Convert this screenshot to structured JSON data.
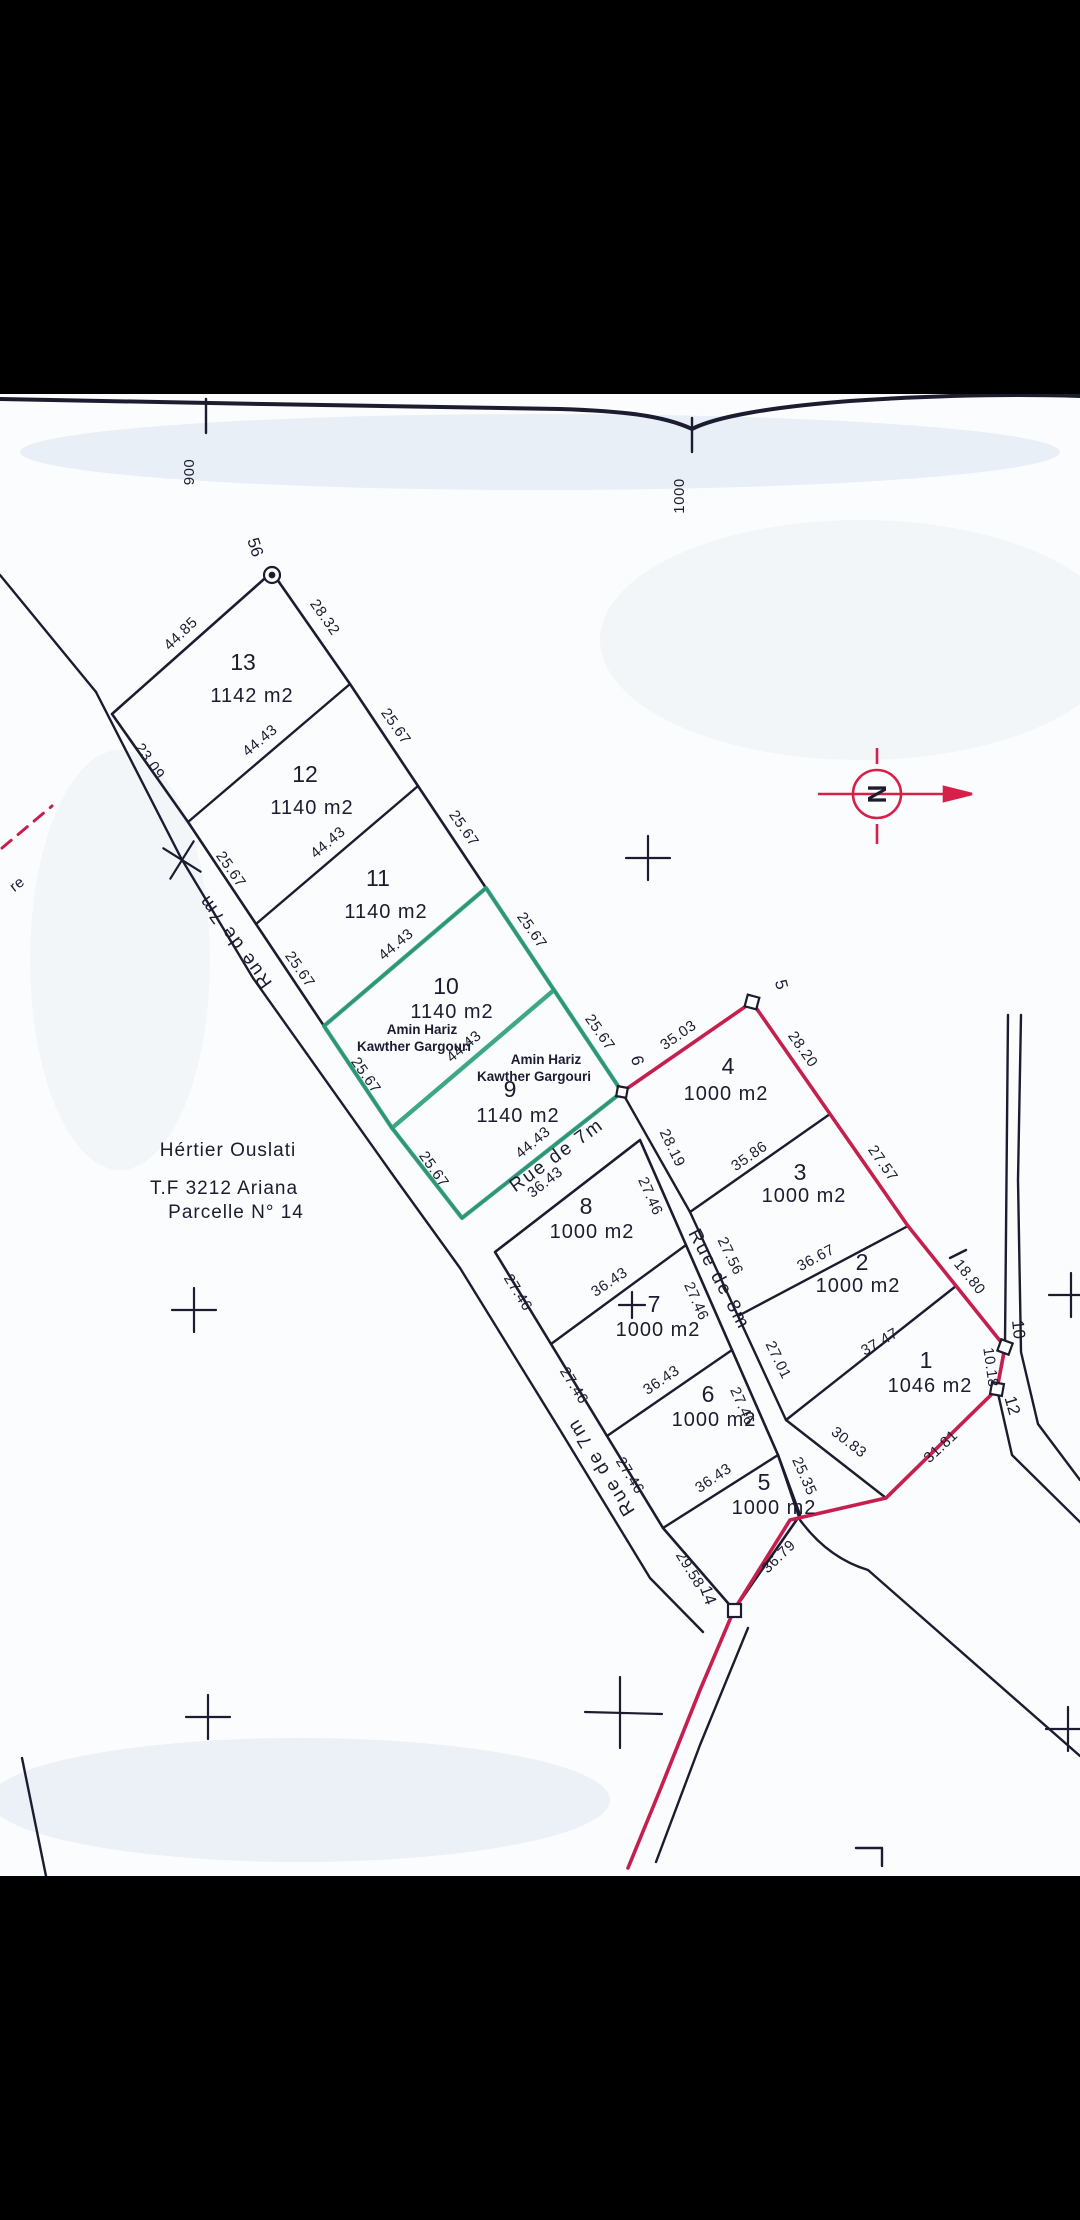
{
  "document_type": "cadastral-subdivision-plan",
  "title_block": {
    "l1": "Hértier Ouslati",
    "l2": "T.F 3212 Ariana",
    "l3": "Parcelle N° 14"
  },
  "ruler": {
    "r900": "900",
    "r1000": "1000"
  },
  "north": {
    "label": "N"
  },
  "edge_fragment": "re",
  "roads": {
    "rue7a": "Rue de 7m",
    "rue7b": "Rue de 7m",
    "rue7c": "Rue de 7m",
    "rue8": "Rue de 8m"
  },
  "vertices": {
    "v56": "56",
    "v5": "5",
    "v6": "6",
    "v12": "12",
    "v14": "14",
    "road10": "10"
  },
  "owners": {
    "o10": {
      "l1": "Amin Hariz",
      "l2": "Kawther Gargouri"
    },
    "o9": {
      "l1": "Amin Hariz",
      "l2": "Kawther Gargouri"
    }
  },
  "parcels": {
    "p13": {
      "num": "13",
      "area": "1142 m2"
    },
    "p12": {
      "num": "12",
      "area": "1140 m2"
    },
    "p11": {
      "num": "11",
      "area": "1140 m2"
    },
    "p10": {
      "num": "10",
      "area": "1140 m2"
    },
    "p9": {
      "num": "9",
      "area": "1140 m2"
    },
    "p8": {
      "num": "8",
      "area": "1000 m2"
    },
    "p7": {
      "num": "7",
      "area": "1000 m2"
    },
    "p6": {
      "num": "6",
      "area": "1000 m2"
    },
    "p5": {
      "num": "5",
      "area": "1000 m2"
    },
    "p4": {
      "num": "4",
      "area": "1000 m2"
    },
    "p3": {
      "num": "3",
      "area": "1000 m2"
    },
    "p2": {
      "num": "2",
      "area": "1000 m2"
    },
    "p1": {
      "num": "1",
      "area": "1046 m2"
    }
  },
  "dims": {
    "p13_nw": "44.85",
    "p13_ne": "28.32",
    "p13_se": "44.43",
    "p12_ne": "25.67",
    "p12_sw": "25.67",
    "p12_se": "44.43",
    "p11_ne": "25.67",
    "p11_sw": "25.67",
    "p11_se": "44.43",
    "p10_ne": "25.67",
    "p10_sw": "25.67",
    "p10_se": "44.43",
    "p9_ne": "25.67",
    "p9_sw": "25.67",
    "p9_se": "44.43",
    "road23": "23.09",
    "p4_nw": "35.03",
    "p4_ne": "28.20",
    "p4_sw": "28.19",
    "p4_se": "35.86",
    "p3_ne": "27.57",
    "p3_sw": "27.56",
    "p3_se": "36.67",
    "p2_sw": "27.01",
    "p2_se": "37.47",
    "p1_ne": "18.80",
    "p1_e": "10.18",
    "p1_se": "31.81",
    "p1_sw": "30.83",
    "p8_nw": "36.43",
    "p8_ne": "27.46",
    "p8_sw": "27.46",
    "p8_se": "36.43",
    "p7_ne": "27.46",
    "p7_sw": "27.46",
    "p7_se": "36.43",
    "p6_ne": "27.46",
    "p6_sw": "27.46",
    "p6_se": "36.43",
    "p5_ne": "25.35",
    "p5_sw": "29.58",
    "p5_se": "36.79"
  },
  "colors": {
    "ink": "#1c1c30",
    "boundary_red": "#c51f4e",
    "highlight_green": "#2fa07c"
  }
}
